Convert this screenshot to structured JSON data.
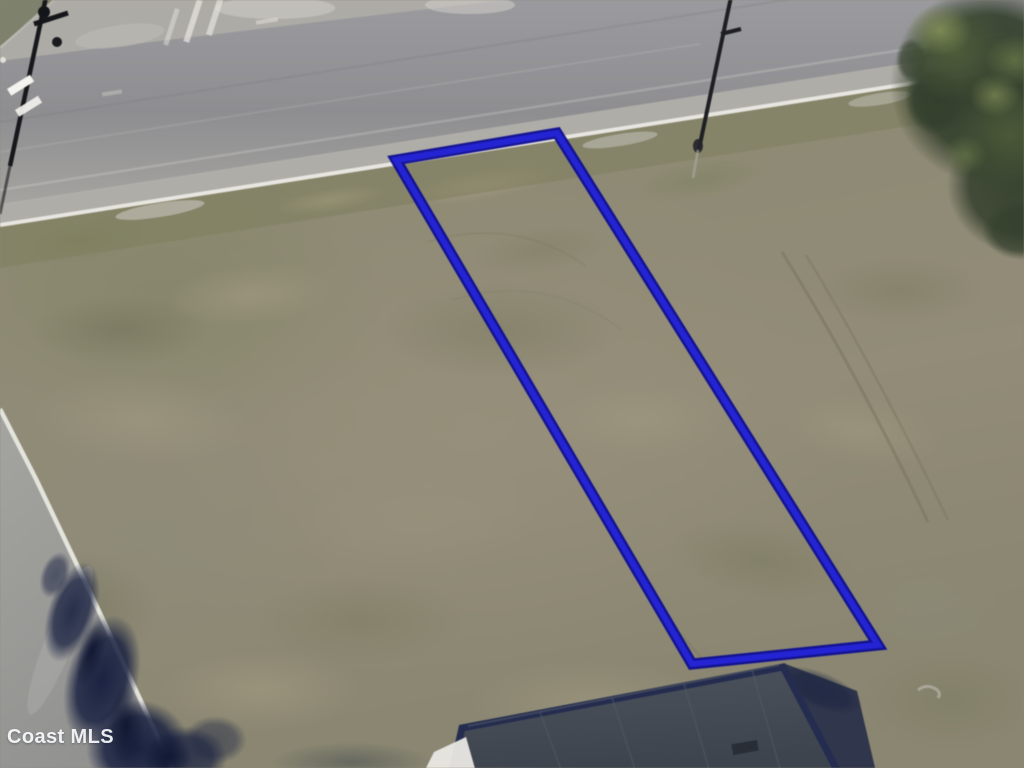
{
  "watermark": {
    "text": "Coast MLS",
    "color": "#ffffff"
  },
  "lot": {
    "outline_points": "396,160 557,133 878,645 692,664",
    "outline_edge_color": "#0d0d92",
    "outline_core_color": "#2424d4"
  },
  "scene": {
    "field_color": "#8c8874",
    "road_color": "#8f8f93",
    "road_shoulder_color": "#b1afaa",
    "curb_line_color": "#edebe6",
    "verge_color": "#7e7d5c",
    "left_road_color": "#9b9b97",
    "tree_canopy_color": "#34402d",
    "tree_shadow_color": "#1b2342",
    "building_roof_color": "#474d57",
    "building_roof_edge_color": "#242d4f",
    "white_patch_color": "#eae8e3"
  }
}
